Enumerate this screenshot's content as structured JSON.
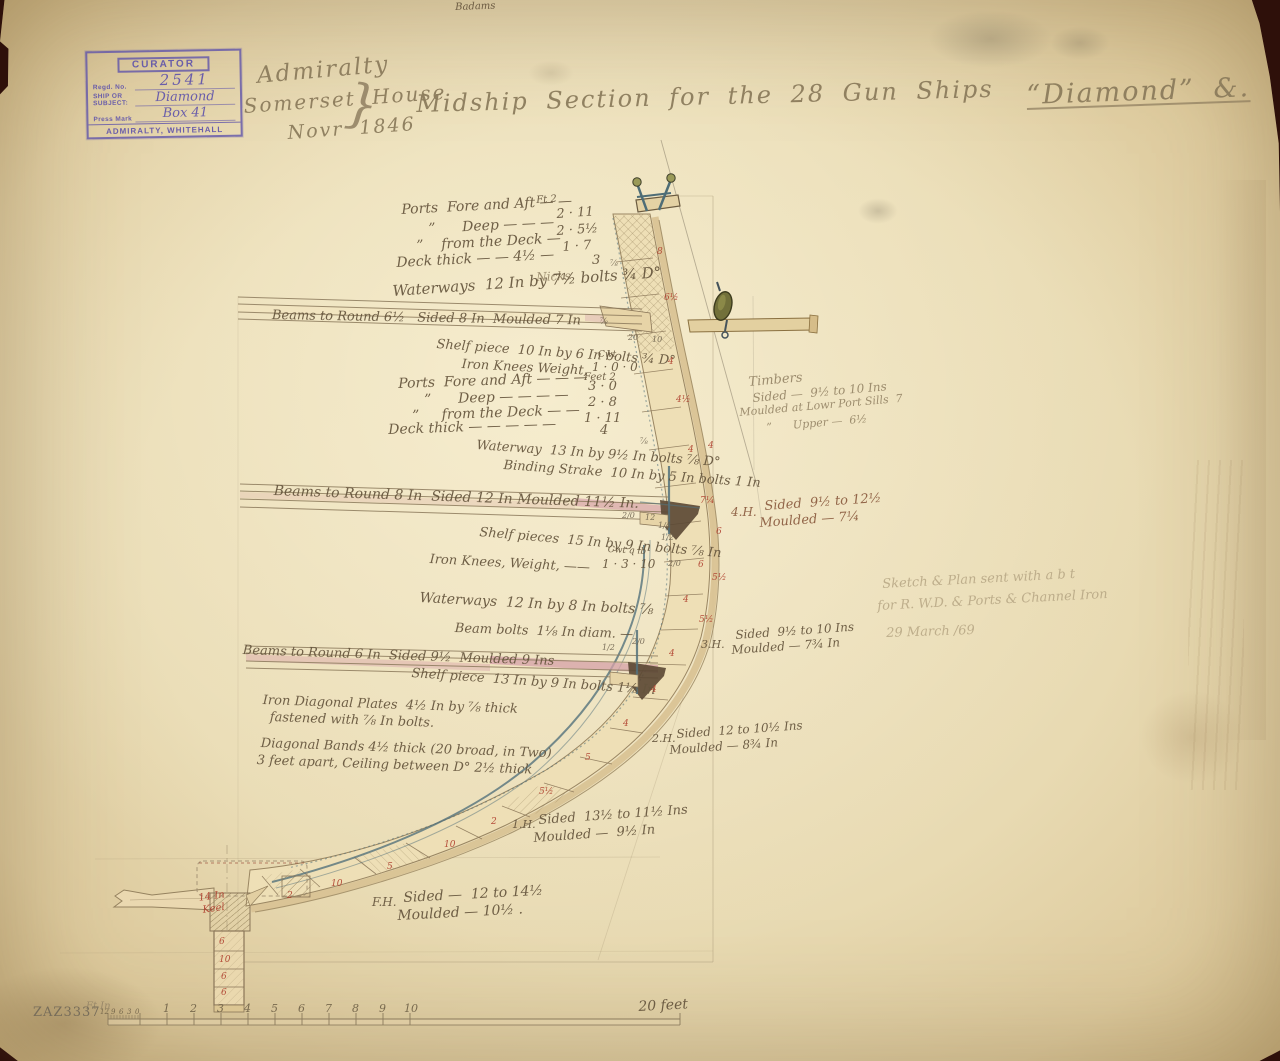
{
  "stamp": {
    "header": "CURATOR",
    "regd_label": "Regd. No.",
    "regd_value": "2541",
    "ship_label": "SHIP OR",
    "subject_label": "SUBJECT:",
    "ship_value": "Diamond",
    "press_label": "Press Mark",
    "press_value": "Box 41",
    "footer": "ADMIRALTY, WHITEHALL"
  },
  "colors": {
    "paper": "#e8dab4",
    "ink": "#64543c",
    "pencil": "#97876a",
    "red_ink": "#b0413a",
    "iron_blue": "#54727c",
    "deck_pink": "#c87f9e",
    "stamp_purple": "#5f54aa",
    "olive_block": "#72703a"
  },
  "overlay_texts": [
    {
      "t": "Admiralty",
      "x": 256,
      "y": 64,
      "s": 23,
      "r": -5,
      "c": "title",
      "n": "title-office"
    },
    {
      "t": "Somerset House",
      "x": 243,
      "y": 96,
      "s": 20,
      "r": -4,
      "c": "title",
      "n": "title-location"
    },
    {
      "t": "Novr 1846",
      "x": 287,
      "y": 124,
      "s": 19,
      "r": -4,
      "c": "title",
      "n": "title-date"
    },
    {
      "t": "}",
      "x": 348,
      "y": 76,
      "s": 52,
      "r": 6,
      "c": "pencil",
      "n": "title-flourish"
    },
    {
      "t": "Midship Section for the 28 Gun Ships",
      "x": 416,
      "y": 92,
      "s": 24,
      "r": -1.5,
      "c": "title",
      "n": "title-main"
    },
    {
      "t": "“Diamond” &.",
      "x": 1026,
      "y": 82,
      "s": 27,
      "r": -2,
      "c": "title",
      "u": true,
      "n": "title-ship-name"
    },
    {
      "t": "Badams",
      "x": 455,
      "y": 3,
      "s": 10,
      "r": -2,
      "c": "ink",
      "n": "pencil-scribble"
    },
    {
      "t": "Ft 2",
      "x": 536,
      "y": 196,
      "s": 10,
      "r": -4,
      "c": "ink"
    },
    {
      "t": "Ports  Fore and Aft — —",
      "x": 401,
      "y": 203,
      "s": 14,
      "r": -3,
      "c": "ink"
    },
    {
      "t": "2 · 11",
      "x": 556,
      "y": 208,
      "s": 13,
      "r": -4,
      "c": "ink"
    },
    {
      "t": "”      Deep — — —",
      "x": 428,
      "y": 222,
      "s": 14,
      "r": -3,
      "c": "ink"
    },
    {
      "t": "2 · 5½",
      "x": 556,
      "y": 225,
      "s": 13,
      "r": -4,
      "c": "ink"
    },
    {
      "t": "”    from the Deck —",
      "x": 416,
      "y": 239,
      "s": 14,
      "r": -3,
      "c": "ink"
    },
    {
      "t": "1 · 7",
      "x": 562,
      "y": 241,
      "s": 13,
      "r": -4,
      "c": "ink"
    },
    {
      "t": "Deck thick — — 4½ —",
      "x": 396,
      "y": 256,
      "s": 14,
      "r": -3,
      "c": "ink"
    },
    {
      "t": "3",
      "x": 592,
      "y": 254,
      "s": 13,
      "r": 0,
      "c": "ink"
    },
    {
      "t": "Nicks",
      "x": 536,
      "y": 271,
      "s": 12,
      "r": -2,
      "c": "pencil"
    },
    {
      "t": "Waterways  12 In by 7½ bolts ¾ D°",
      "x": 392,
      "y": 284,
      "s": 15,
      "r": -4,
      "c": "ink"
    },
    {
      "t": "Beams to Round 6½   Sided 8 In  Moulded 7 In",
      "x": 272,
      "y": 309,
      "s": 13,
      "r": 1,
      "c": "ink"
    },
    {
      "t": "Shelf piece  10 In by 6 In bolts ¾ D°",
      "x": 437,
      "y": 338,
      "s": 13,
      "r": 4,
      "c": "ink"
    },
    {
      "t": "Cwt",
      "x": 598,
      "y": 351,
      "s": 9,
      "r": 0,
      "c": "ink"
    },
    {
      "t": "Iron Knees Weight,",
      "x": 462,
      "y": 358,
      "s": 13,
      "r": 3,
      "c": "ink"
    },
    {
      "t": "1 · 0 · 0",
      "x": 592,
      "y": 361,
      "s": 12,
      "r": 0,
      "c": "ink"
    },
    {
      "t": "Feet 2",
      "x": 584,
      "y": 373,
      "s": 10,
      "r": 0,
      "c": "ink"
    },
    {
      "t": "Ports  Fore and Aft — — —",
      "x": 398,
      "y": 377,
      "s": 14,
      "r": -2,
      "c": "ink"
    },
    {
      "t": "3 · 0",
      "x": 588,
      "y": 380,
      "s": 13,
      "r": 0,
      "c": "ink"
    },
    {
      "t": "”      Deep — — — —",
      "x": 424,
      "y": 393,
      "s": 14,
      "r": -2,
      "c": "ink"
    },
    {
      "t": "2 · 8",
      "x": 588,
      "y": 396,
      "s": 13,
      "r": 0,
      "c": "ink"
    },
    {
      "t": "”     from the Deck — —",
      "x": 412,
      "y": 409,
      "s": 14,
      "r": -2,
      "c": "ink"
    },
    {
      "t": "1 · 11",
      "x": 584,
      "y": 412,
      "s": 13,
      "r": 0,
      "c": "ink"
    },
    {
      "t": "Deck thick — — — — —",
      "x": 388,
      "y": 423,
      "s": 14,
      "r": -2,
      "c": "ink"
    },
    {
      "t": "4",
      "x": 600,
      "y": 424,
      "s": 13,
      "r": 0,
      "c": "ink"
    },
    {
      "t": "Waterway  13 In by 9½ In bolts ⅞ D°",
      "x": 477,
      "y": 439,
      "s": 13,
      "r": 4,
      "c": "ink"
    },
    {
      "t": "Binding Strake  10 In by 5 In bolts 1 In",
      "x": 504,
      "y": 459,
      "s": 13,
      "r": 4,
      "c": "ink"
    },
    {
      "t": "Timbers",
      "x": 748,
      "y": 376,
      "s": 13,
      "r": -5,
      "c": "pencil"
    },
    {
      "t": "Sided —  9½ to 10 Ins",
      "x": 752,
      "y": 392,
      "s": 12,
      "r": -5,
      "c": "pencil"
    },
    {
      "t": "Moulded at Lowr Port Sills  7",
      "x": 739,
      "y": 407,
      "s": 11,
      "r": -5,
      "c": "pencil"
    },
    {
      "t": "”      Upper —  6½",
      "x": 766,
      "y": 422,
      "s": 11,
      "r": -5,
      "c": "pencil"
    },
    {
      "t": "Beams to Round 8 In  Sided 12 In Moulded 11½ In.",
      "x": 274,
      "y": 484,
      "s": 14,
      "r": 2,
      "c": "ink"
    },
    {
      "t": "4.H.",
      "x": 731,
      "y": 506,
      "s": 12,
      "r": 0,
      "c": "ink2"
    },
    {
      "t": "Sided  9½ to 12½",
      "x": 764,
      "y": 500,
      "s": 13,
      "r": -4,
      "c": "ink2"
    },
    {
      "t": "Moulded — 7¼",
      "x": 759,
      "y": 517,
      "s": 13,
      "r": -4,
      "c": "ink2"
    },
    {
      "t": "Shelf pieces  15 In by 9 In bolts ⅞ In",
      "x": 480,
      "y": 526,
      "s": 13,
      "r": 5,
      "c": "ink"
    },
    {
      "t": "Cwt q lb",
      "x": 608,
      "y": 546,
      "s": 9,
      "r": 3,
      "c": "ink"
    },
    {
      "t": "Iron Knees, Weight, ——",
      "x": 430,
      "y": 553,
      "s": 13,
      "r": 3,
      "c": "ink"
    },
    {
      "t": "1 · 3 · 10",
      "x": 602,
      "y": 558,
      "s": 12,
      "r": 0,
      "c": "ink"
    },
    {
      "t": "Waterways  12 In by 8 In bolts ⅞",
      "x": 420,
      "y": 591,
      "s": 14,
      "r": 3,
      "c": "ink"
    },
    {
      "t": "Beam bolts  1⅛ In diam. —",
      "x": 455,
      "y": 622,
      "s": 13,
      "r": 2,
      "c": "ink"
    },
    {
      "t": "Beams to Round 6 In  Sided 9½  Moulded 9 Ins",
      "x": 243,
      "y": 644,
      "s": 13,
      "r": 2,
      "c": "ink"
    },
    {
      "t": "Shelf piece  13 In by 9 In bolts 1⅛ In",
      "x": 412,
      "y": 667,
      "s": 13,
      "r": 4,
      "c": "ink"
    },
    {
      "t": "3.H.",
      "x": 701,
      "y": 639,
      "s": 11,
      "r": 0,
      "c": "ink"
    },
    {
      "t": "Sided  9½ to 10 Ins",
      "x": 735,
      "y": 629,
      "s": 12,
      "r": -4,
      "c": "ink"
    },
    {
      "t": "Moulded — 7¾ In",
      "x": 731,
      "y": 644,
      "s": 12,
      "r": -4,
      "c": "ink"
    },
    {
      "t": "Iron Diagonal Plates  4½ In by ⅞ thick",
      "x": 263,
      "y": 694,
      "s": 13,
      "r": 2,
      "c": "ink"
    },
    {
      "t": "fastened with ⅞ In bolts.",
      "x": 270,
      "y": 711,
      "s": 13,
      "r": 2,
      "c": "ink"
    },
    {
      "t": "Diagonal Bands 4½ thick (20 broad, in Two)",
      "x": 261,
      "y": 737,
      "s": 13,
      "r": 2,
      "c": "ink"
    },
    {
      "t": "3 feet apart, Ceiling between D° 2½ thick",
      "x": 257,
      "y": 754,
      "s": 13,
      "r": 2,
      "c": "ink"
    },
    {
      "t": "2.H.",
      "x": 652,
      "y": 733,
      "s": 11,
      "r": 0,
      "c": "ink"
    },
    {
      "t": "Sided  12 to 10½ Ins",
      "x": 676,
      "y": 728,
      "s": 12,
      "r": -4,
      "c": "ink"
    },
    {
      "t": "Moulded — 8¾ In",
      "x": 669,
      "y": 744,
      "s": 12,
      "r": -4,
      "c": "ink"
    },
    {
      "t": "1.H.",
      "x": 512,
      "y": 819,
      "s": 11,
      "r": 0,
      "c": "ink"
    },
    {
      "t": "Sided  13½ to 11½ Ins",
      "x": 538,
      "y": 814,
      "s": 13,
      "r": -4,
      "c": "ink"
    },
    {
      "t": "Moulded —  9½ In",
      "x": 533,
      "y": 832,
      "s": 13,
      "r": -4,
      "c": "ink"
    },
    {
      "t": "F.H.",
      "x": 372,
      "y": 896,
      "s": 12,
      "r": 0,
      "c": "ink"
    },
    {
      "t": "Sided —  12 to 14½",
      "x": 403,
      "y": 891,
      "s": 14,
      "r": -3,
      "c": "ink"
    },
    {
      "t": "Moulded — 10½ .",
      "x": 397,
      "y": 909,
      "s": 14,
      "r": -3,
      "c": "ink"
    },
    {
      "t": "Sketch & Plan sent with a b t",
      "x": 882,
      "y": 578,
      "s": 13,
      "r": -3,
      "c": "faint",
      "n": "pencil-note"
    },
    {
      "t": "for R. W.D. & Ports & Channel Iron",
      "x": 877,
      "y": 600,
      "s": 13,
      "r": -3,
      "c": "faint",
      "n": "pencil-note"
    },
    {
      "t": "29 March /69",
      "x": 886,
      "y": 627,
      "s": 13,
      "r": -2,
      "c": "faint",
      "n": "pencil-note"
    },
    {
      "t": "8",
      "x": 657,
      "y": 248,
      "s": 9,
      "r": 0,
      "c": "red",
      "n": "red-dimension"
    },
    {
      "t": "6½",
      "x": 664,
      "y": 294,
      "s": 9,
      "r": 0,
      "c": "red",
      "n": "red-dimension"
    },
    {
      "t": "4",
      "x": 668,
      "y": 358,
      "s": 9,
      "r": 0,
      "c": "red",
      "n": "red-dimension"
    },
    {
      "t": "4½",
      "x": 676,
      "y": 396,
      "s": 9,
      "r": 0,
      "c": "red",
      "n": "red-dimension"
    },
    {
      "t": "4",
      "x": 688,
      "y": 446,
      "s": 9,
      "r": 0,
      "c": "red",
      "n": "red-dimension"
    },
    {
      "t": "4",
      "x": 708,
      "y": 442,
      "s": 9,
      "r": 0,
      "c": "red",
      "n": "red-dimension"
    },
    {
      "t": "7¼",
      "x": 700,
      "y": 497,
      "s": 9,
      "r": 0,
      "c": "red",
      "n": "red-dimension"
    },
    {
      "t": "6",
      "x": 716,
      "y": 528,
      "s": 9,
      "r": 0,
      "c": "red",
      "n": "red-dimension"
    },
    {
      "t": "6",
      "x": 698,
      "y": 561,
      "s": 9,
      "r": 0,
      "c": "red",
      "n": "red-dimension"
    },
    {
      "t": "5½",
      "x": 712,
      "y": 574,
      "s": 9,
      "r": 0,
      "c": "red",
      "n": "red-dimension"
    },
    {
      "t": "4",
      "x": 683,
      "y": 596,
      "s": 9,
      "r": 0,
      "c": "red",
      "n": "red-dimension"
    },
    {
      "t": "5½",
      "x": 699,
      "y": 616,
      "s": 9,
      "r": 0,
      "c": "red",
      "n": "red-dimension"
    },
    {
      "t": "4",
      "x": 669,
      "y": 650,
      "s": 9,
      "r": 0,
      "c": "red",
      "n": "red-dimension"
    },
    {
      "t": "4",
      "x": 651,
      "y": 686,
      "s": 9,
      "r": 0,
      "c": "red",
      "n": "red-dimension"
    },
    {
      "t": "4",
      "x": 623,
      "y": 720,
      "s": 9,
      "r": 0,
      "c": "red",
      "n": "red-dimension"
    },
    {
      "t": "5",
      "x": 585,
      "y": 754,
      "s": 9,
      "r": 0,
      "c": "red",
      "n": "red-dimension"
    },
    {
      "t": "5½",
      "x": 539,
      "y": 788,
      "s": 9,
      "r": 0,
      "c": "red",
      "n": "red-dimension"
    },
    {
      "t": "2",
      "x": 491,
      "y": 818,
      "s": 9,
      "r": 0,
      "c": "red",
      "n": "red-dimension"
    },
    {
      "t": "10",
      "x": 444,
      "y": 841,
      "s": 9,
      "r": 0,
      "c": "red",
      "n": "red-dimension"
    },
    {
      "t": "5",
      "x": 387,
      "y": 863,
      "s": 9,
      "r": 0,
      "c": "red",
      "n": "red-dimension"
    },
    {
      "t": "10",
      "x": 331,
      "y": 880,
      "s": 9,
      "r": 0,
      "c": "red",
      "n": "red-dimension"
    },
    {
      "t": "2",
      "x": 287,
      "y": 892,
      "s": 9,
      "r": 0,
      "c": "red",
      "n": "red-dimension"
    },
    {
      "t": "6",
      "x": 219,
      "y": 938,
      "s": 9,
      "r": 0,
      "c": "red",
      "n": "red-dimension"
    },
    {
      "t": "10",
      "x": 219,
      "y": 956,
      "s": 9,
      "r": 0,
      "c": "red",
      "n": "red-dimension"
    },
    {
      "t": "6",
      "x": 221,
      "y": 973,
      "s": 9,
      "r": 0,
      "c": "red",
      "n": "red-dimension"
    },
    {
      "t": "6",
      "x": 221,
      "y": 989,
      "s": 9,
      "r": 0,
      "c": "red",
      "n": "red-dimension"
    },
    {
      "t": "14 In",
      "x": 198,
      "y": 894,
      "s": 10,
      "r": -8,
      "c": "red",
      "n": "red-dimension"
    },
    {
      "t": "Keel",
      "x": 202,
      "y": 906,
      "s": 10,
      "r": -8,
      "c": "red",
      "n": "red-dimension"
    },
    {
      "t": "20",
      "x": 628,
      "y": 334,
      "s": 8,
      "r": 0,
      "c": "tiny",
      "n": "dimension-mark"
    },
    {
      "t": "10",
      "x": 652,
      "y": 336,
      "s": 8,
      "r": 0,
      "c": "tiny",
      "n": "dimension-mark"
    },
    {
      "t": "⅞",
      "x": 610,
      "y": 260,
      "s": 8,
      "r": 0,
      "c": "tiny",
      "n": "dimension-mark"
    },
    {
      "t": "⅞",
      "x": 600,
      "y": 318,
      "s": 8,
      "r": 0,
      "c": "tiny",
      "n": "dimension-mark"
    },
    {
      "t": "⅞",
      "x": 640,
      "y": 438,
      "s": 8,
      "r": 0,
      "c": "tiny",
      "n": "dimension-mark"
    },
    {
      "t": "2/0",
      "x": 622,
      "y": 512,
      "s": 8,
      "r": 0,
      "c": "tiny",
      "n": "dimension-mark"
    },
    {
      "t": "12",
      "x": 645,
      "y": 514,
      "s": 8,
      "r": 0,
      "c": "tiny",
      "n": "dimension-mark"
    },
    {
      "t": "1/4",
      "x": 658,
      "y": 522,
      "s": 8,
      "r": 0,
      "c": "tiny",
      "n": "dimension-mark"
    },
    {
      "t": "1/2",
      "x": 661,
      "y": 534,
      "s": 8,
      "r": 0,
      "c": "tiny",
      "n": "dimension-mark"
    },
    {
      "t": "2/0",
      "x": 668,
      "y": 560,
      "s": 8,
      "r": 0,
      "c": "tiny",
      "n": "dimension-mark"
    },
    {
      "t": "2/0",
      "x": 632,
      "y": 638,
      "s": 8,
      "r": 0,
      "c": "tiny",
      "n": "dimension-mark"
    },
    {
      "t": "1/2",
      "x": 602,
      "y": 644,
      "s": 8,
      "r": 0,
      "c": "tiny",
      "n": "dimension-mark"
    },
    {
      "t": "Ft In",
      "x": 86,
      "y": 1002,
      "s": 10,
      "r": 0,
      "c": "pencil",
      "n": "scale-prefix"
    },
    {
      "t": "12",
      "x": 100,
      "y": 1009,
      "s": 7,
      "r": 0,
      "c": "scale",
      "n": "scale-number"
    },
    {
      "t": "9",
      "x": 111,
      "y": 1009,
      "s": 7,
      "r": 0,
      "c": "scale",
      "n": "scale-number"
    },
    {
      "t": "6",
      "x": 119,
      "y": 1009,
      "s": 7,
      "r": 0,
      "c": "scale",
      "n": "scale-number"
    },
    {
      "t": "3",
      "x": 127,
      "y": 1009,
      "s": 7,
      "r": 0,
      "c": "scale",
      "n": "scale-number"
    },
    {
      "t": "0",
      "x": 135,
      "y": 1009,
      "s": 7,
      "r": 0,
      "c": "scale",
      "n": "scale-number"
    },
    {
      "t": "1",
      "x": 163,
      "y": 1003,
      "s": 11,
      "r": 0,
      "c": "scale",
      "n": "scale-number"
    },
    {
      "t": "2",
      "x": 190,
      "y": 1003,
      "s": 11,
      "r": 0,
      "c": "scale",
      "n": "scale-number"
    },
    {
      "t": "3",
      "x": 217,
      "y": 1003,
      "s": 11,
      "r": 0,
      "c": "scale",
      "n": "scale-number"
    },
    {
      "t": "4",
      "x": 244,
      "y": 1003,
      "s": 11,
      "r": 0,
      "c": "scale",
      "n": "scale-number"
    },
    {
      "t": "5",
      "x": 271,
      "y": 1003,
      "s": 11,
      "r": 0,
      "c": "scale",
      "n": "scale-number"
    },
    {
      "t": "6",
      "x": 298,
      "y": 1003,
      "s": 11,
      "r": 0,
      "c": "scale",
      "n": "scale-number"
    },
    {
      "t": "7",
      "x": 325,
      "y": 1003,
      "s": 11,
      "r": 0,
      "c": "scale",
      "n": "scale-number"
    },
    {
      "t": "8",
      "x": 352,
      "y": 1003,
      "s": 11,
      "r": 0,
      "c": "scale",
      "n": "scale-number"
    },
    {
      "t": "9",
      "x": 379,
      "y": 1003,
      "s": 11,
      "r": 0,
      "c": "scale",
      "n": "scale-number"
    },
    {
      "t": "10",
      "x": 404,
      "y": 1003,
      "s": 11,
      "r": 0,
      "c": "scale",
      "n": "scale-number"
    },
    {
      "t": "20 feet",
      "x": 638,
      "y": 1000,
      "s": 14,
      "r": -3,
      "c": "ink",
      "n": "scale-end-label"
    },
    {
      "t": "ZAZ3337",
      "x": 33,
      "y": 1006,
      "s": 13,
      "r": 0,
      "c": "cat",
      "n": "catalog-number"
    }
  ]
}
